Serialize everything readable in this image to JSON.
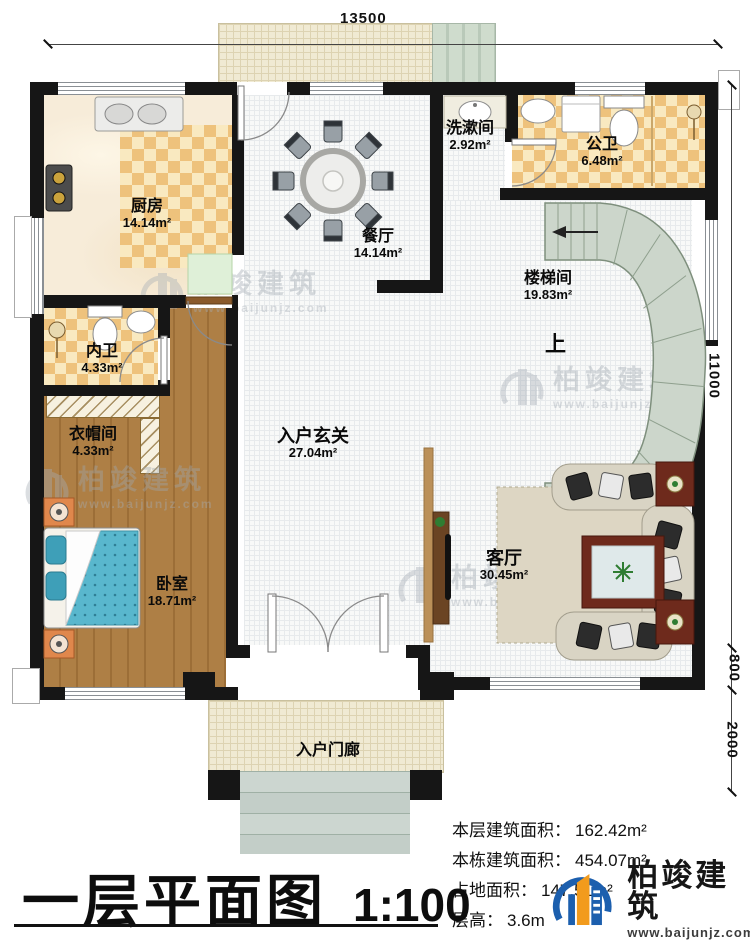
{
  "plan": {
    "title": "一层平面图",
    "scale": "1:100",
    "up_label": "上",
    "dims": {
      "top": "13500",
      "right_height": "11000",
      "right_bay": "800",
      "right_porch": "2000"
    },
    "rooms": [
      {
        "name": "厨房",
        "area": "14.14m²"
      },
      {
        "name": "餐厅",
        "area": "14.14m²"
      },
      {
        "name": "洗漱间",
        "area": "2.92m²"
      },
      {
        "name": "公卫",
        "area": "6.48m²"
      },
      {
        "name": "楼梯间",
        "area": "19.83m²"
      },
      {
        "name": "内卫",
        "area": "4.33m²"
      },
      {
        "name": "衣帽间",
        "area": "4.33m²"
      },
      {
        "name": "入户玄关",
        "area": "27.04m²"
      },
      {
        "name": "卧室",
        "area": "18.71m²"
      },
      {
        "name": "客厅",
        "area": "30.45m²"
      },
      {
        "name": "入户门廊",
        "area": ""
      }
    ],
    "stats": [
      {
        "label": "本层建筑面积：",
        "value": "162.42m²"
      },
      {
        "label": "本栋建筑面积：",
        "value": "454.07m²"
      },
      {
        "label": "占地面积：",
        "value": "147.51m²"
      },
      {
        "label": "层高：",
        "value": "3.6m"
      }
    ],
    "brand": {
      "name": "柏竣建筑",
      "site": "www.baijunjz.com"
    },
    "colors": {
      "wall": "#161616",
      "checker_dark": "#eec27c",
      "checker_light": "#f9e9c0",
      "wood": "#a97c42",
      "stair": "#ccd6cb",
      "accent_blue": "#1c5fae",
      "accent_orange": "#f29b1d"
    }
  }
}
